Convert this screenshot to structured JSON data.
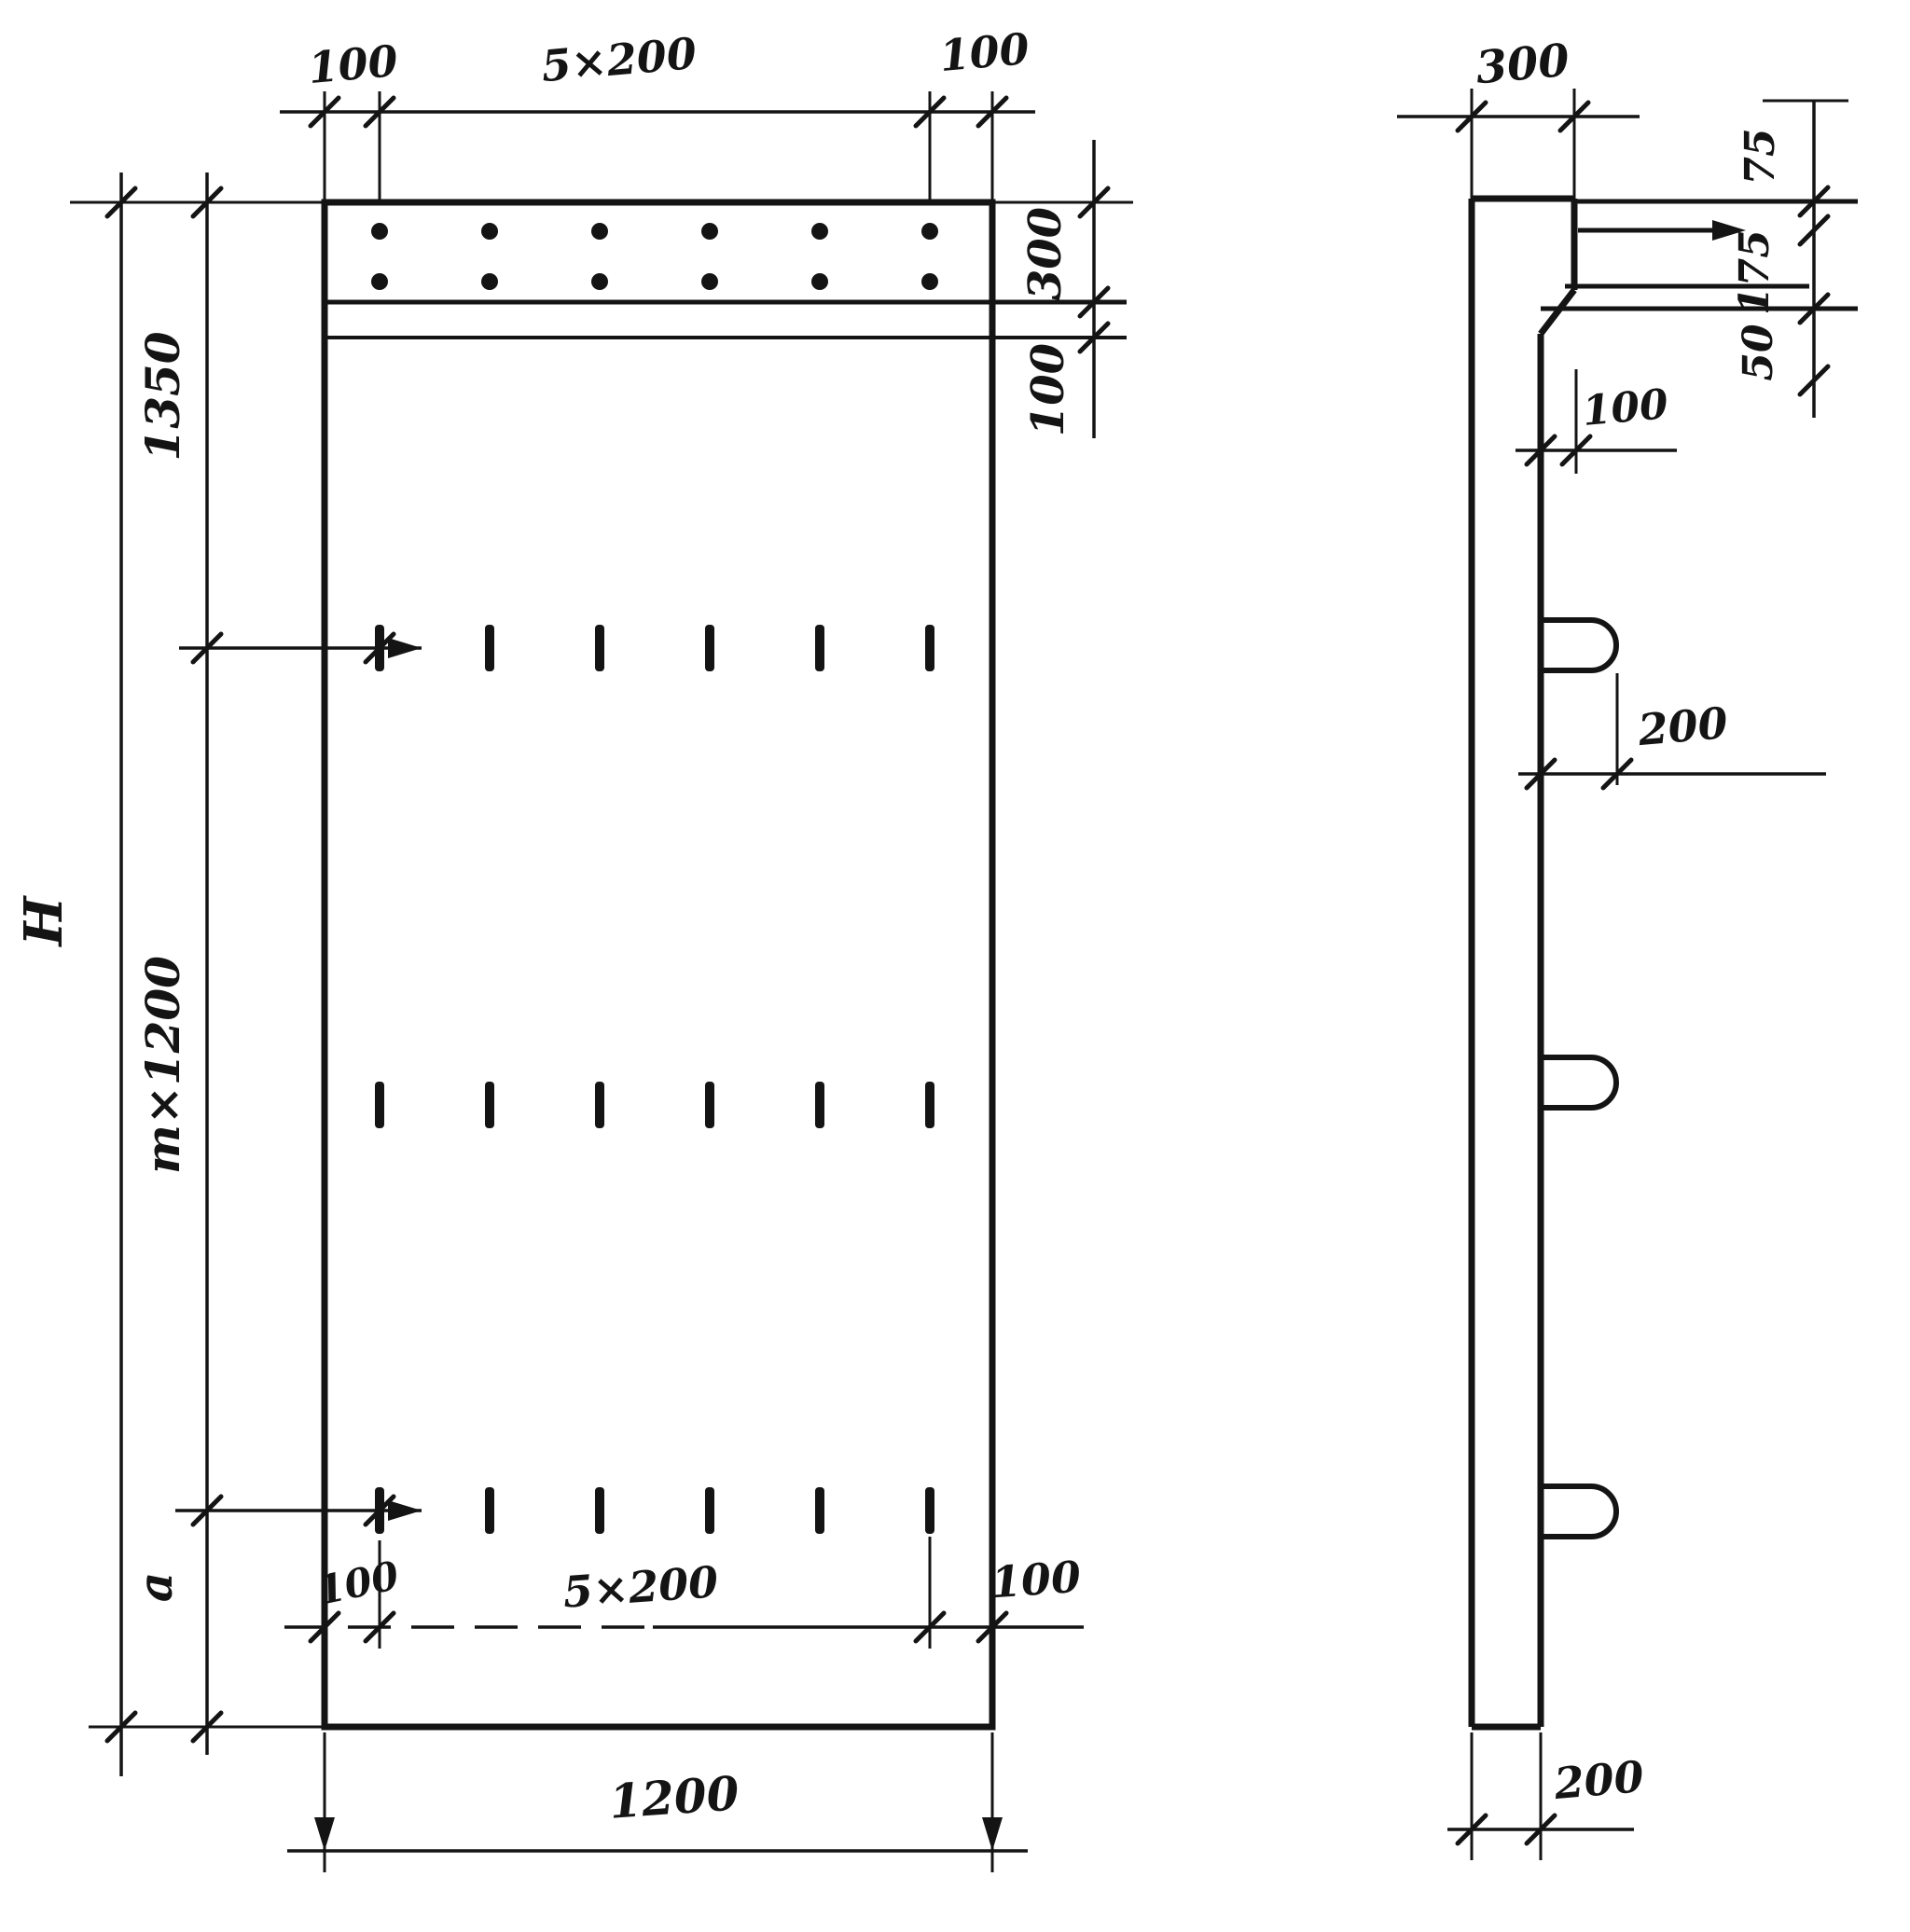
{
  "front_view": {
    "top_dims": {
      "left": "100",
      "middle": "5×200",
      "right": "100"
    },
    "right_dims": {
      "band_height": "300",
      "below_band": "100"
    },
    "left_dims": {
      "overall": "H",
      "top_segment": "1350",
      "middle_segment": "m×1200",
      "bottom_segment": "a"
    },
    "bottom_inner_dims": {
      "left": "100",
      "middle": "5×200",
      "right": "100"
    },
    "bottom_dims": {
      "overall_width": "1200"
    }
  },
  "side_view": {
    "top_thickness": "300",
    "anchor_dims": {
      "top": "75",
      "middle": "175",
      "bottom": "50"
    },
    "step_depth": "100",
    "loop_offset": "200",
    "bottom_thickness": "200"
  }
}
